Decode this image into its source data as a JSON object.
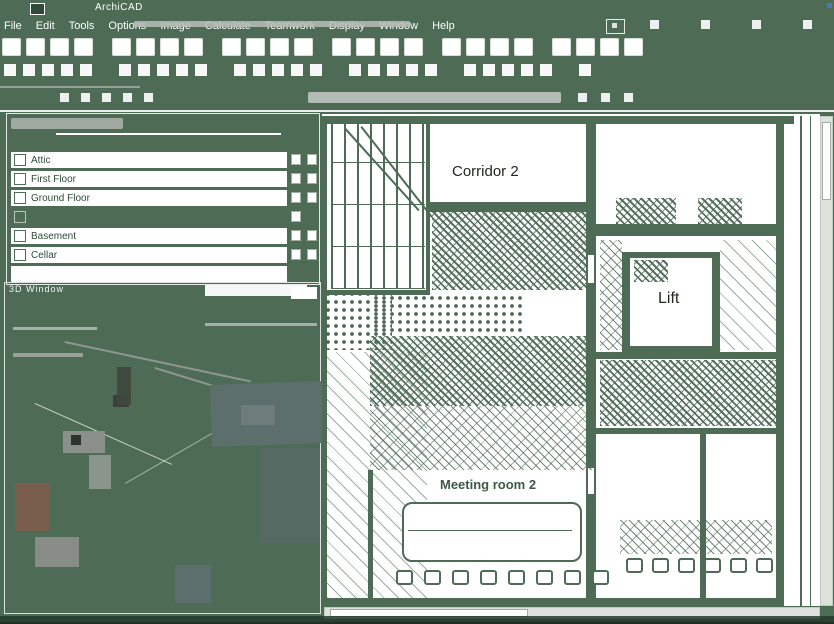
{
  "titlebar": {
    "title": "ArchiCAD"
  },
  "menubar": {
    "items": [
      "File",
      "Edit",
      "Tools",
      "Options",
      "Image",
      "Calculate",
      "Teamwork",
      "Display",
      "Window",
      "Help"
    ]
  },
  "palette": {
    "rows": [
      {
        "label": "Attic"
      },
      {
        "label": "First Floor"
      },
      {
        "label": "Ground Floor"
      },
      {
        "label": ""
      },
      {
        "label": "Basement"
      },
      {
        "label": "Cellar"
      }
    ]
  },
  "viewport3d": {
    "title": "3D Window"
  },
  "plan": {
    "rooms": {
      "corridor": "Corridor 2",
      "lift": "Lift",
      "meeting": "Meeting room 2"
    }
  },
  "colors": {
    "background_green": "#4d6b55",
    "paper_white": "#ffffff",
    "ink_dark": "#20281f",
    "chrome_gray": "#b9bdb9",
    "accent_blue": "#4a79b8",
    "slate_patch": "#5d6f6c",
    "brown_patch": "#7a5e4d"
  }
}
